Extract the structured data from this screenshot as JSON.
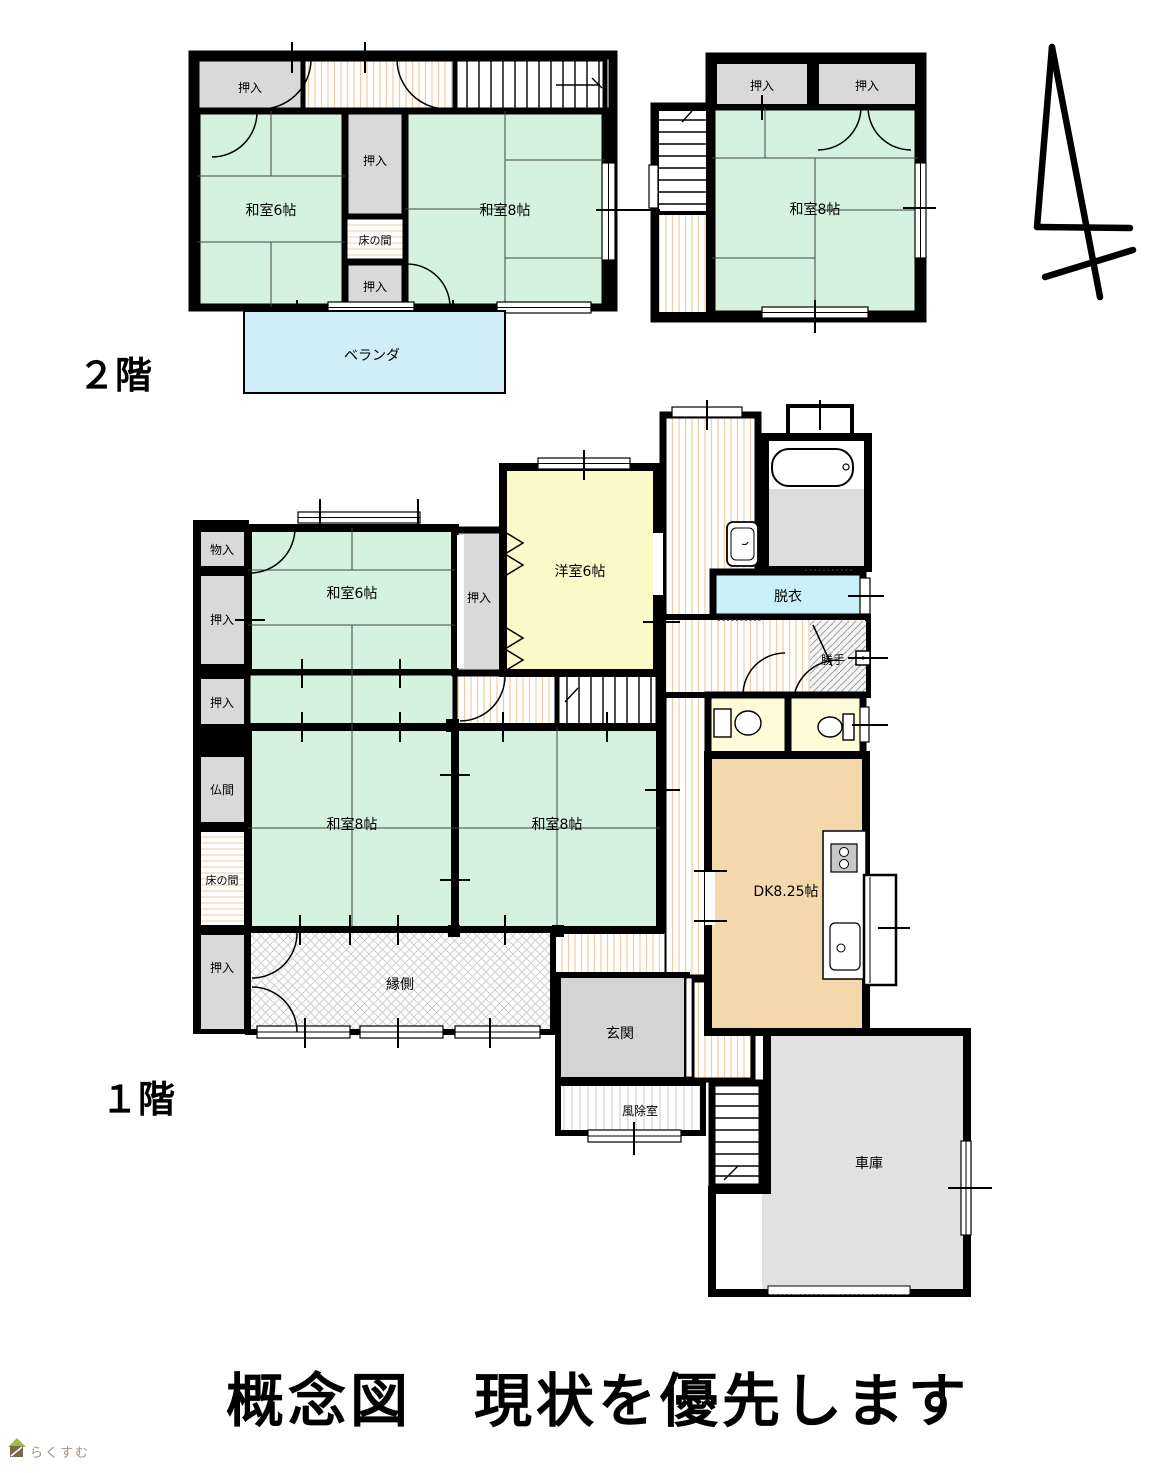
{
  "caption": "概念図　現状を優先します",
  "floor_labels": {
    "second": "２階",
    "first": "１階"
  },
  "watermark": {
    "text": "らくすむ"
  },
  "labels": {
    "oshiire": "押入",
    "monoire": "物入",
    "butsuma": "仏間",
    "tokonoma": "床の間",
    "washitsu6": "和室6帖",
    "washitsu8": "和室8帖",
    "yoshitsu6": "洋室6帖",
    "dk": "DK8.25帖",
    "datsui": "脱衣",
    "katte": "勝手",
    "engawa": "縁側",
    "genkan": "玄関",
    "fujyoshitsu": "風除室",
    "shako": "車庫",
    "veranda": "ベランダ"
  },
  "colors": {
    "wall_black": "#000000",
    "tatami_green": "#d5f2de",
    "closet_gray": "#d9d9d9",
    "western_room_yellow": "#fbf9c8",
    "dk_tan": "#f4d7ab",
    "washroom_cyan": "#c9f0f8",
    "veranda_blue": "#cfeef8",
    "toilet_cream": "#fdfbd8",
    "genkan_gray": "#d4d4d4",
    "garage_gray": "#e2e2e2",
    "bath_floor_gray": "#dcdcdc",
    "floor_stripe_orange": "#f3cda6",
    "watermark_brown": "#a3917f"
  }
}
